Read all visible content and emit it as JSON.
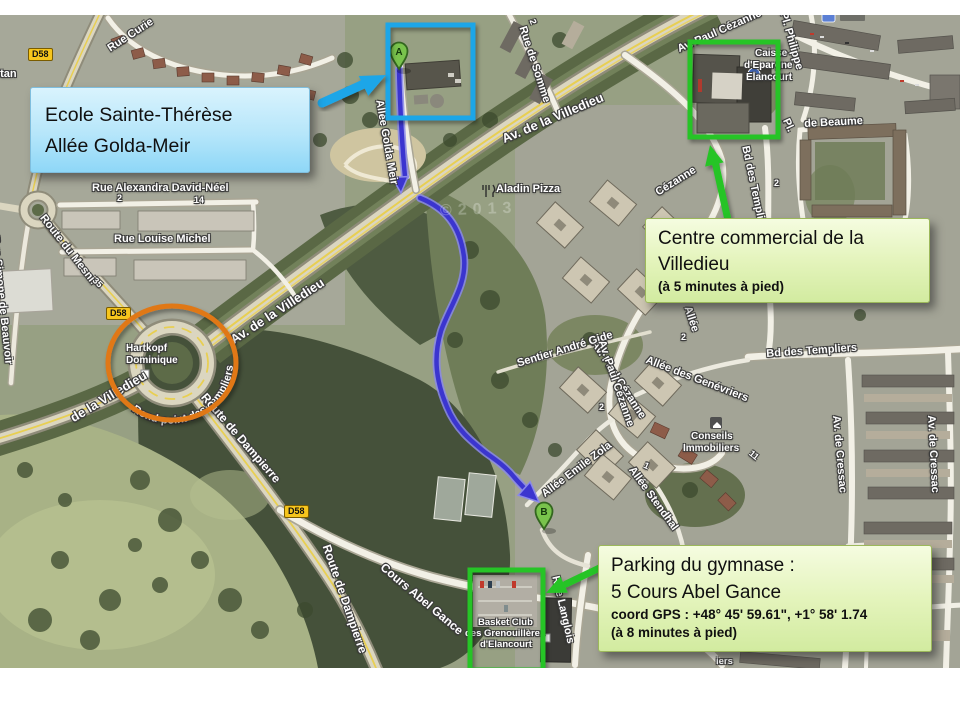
{
  "callouts": {
    "ecole": {
      "line1": "Ecole Sainte-Thérèse",
      "line2": "Allée Golda-Meir"
    },
    "centre": {
      "line1": "Centre commercial de la",
      "line2": "Villedieu",
      "note": "(à 5 minutes à pied)"
    },
    "parking": {
      "line1": "Parking du gymnase :",
      "line2": "5 Cours Abel Gance",
      "gps": " coord GPS : +48° 45' 59.61\", +1° 58' 1.74",
      "note": "(à 8 minutes à pied)"
    }
  },
  "markers": {
    "a": "A",
    "b": "B"
  },
  "badges": {
    "d58": "D58"
  },
  "labels": {
    "stan": "stan",
    "rue_curie": "Rue Curie",
    "rue_de_somme": "Rue de Somme",
    "av_villedieu": "Av. de la Villedieu",
    "villedieu_partial": "de la Villedieu",
    "av_paul_cezanne": "Av. Paul Cézanne",
    "cezanne": "Cézanne",
    "pl_philippe": "Pl. Philippe",
    "caisse1": "Caisse",
    "caisse2": "d'Epargne",
    "caisse3": "Elancourt",
    "euro": "€",
    "pl": "Pl.",
    "de_beaume": "de Beaume",
    "rue_alexandra": "Rue Alexandra David-Néel",
    "rue_louise": "Rue Louise Michel",
    "route_mesnil": "Route du Mesnil",
    "rue_simone": "Rue Simone de Beauvoir",
    "hartkopf1": "Hartkopf",
    "hartkopf2": "Dominique",
    "rond_point": "Rond-point des Templiers",
    "route_dampierre": "Route de Dampierre",
    "cours_abel": "Cours Abel Gance",
    "bd_templiers": "Bd des Templiers",
    "av_cressac": "Av. de Cressac",
    "allee_genevriers": "Allée des Genévriers",
    "sentier_gide": "Sentier André Gide",
    "allee_zola": "Allée Emile Zola",
    "allee_stendhal": "Allée Stendhal",
    "allee_golda": "Allée Golda Meir",
    "allee": "Allée",
    "aladin": "Aladin Pizza",
    "conseils1": "Conseils",
    "conseils2": "Immobiliers",
    "basket1": "Basket Club",
    "basket2": "des Grenouillères",
    "basket3": "d'Elancourt",
    "rue_langlois": "Rue Langlois",
    "iers": "iers",
    "n1": "1",
    "n2": "2",
    "n11": "11",
    "n14": "14",
    "n35": "35",
    "watermark": "©2013"
  },
  "colors": {
    "annotation_blue": "#1fa6e8",
    "annotation_green": "#27c427",
    "annotation_orange": "#e07818",
    "route_blue": "#3b35cf",
    "callout_blue": "#b6e6fa",
    "callout_green": "#e4f4bc"
  }
}
